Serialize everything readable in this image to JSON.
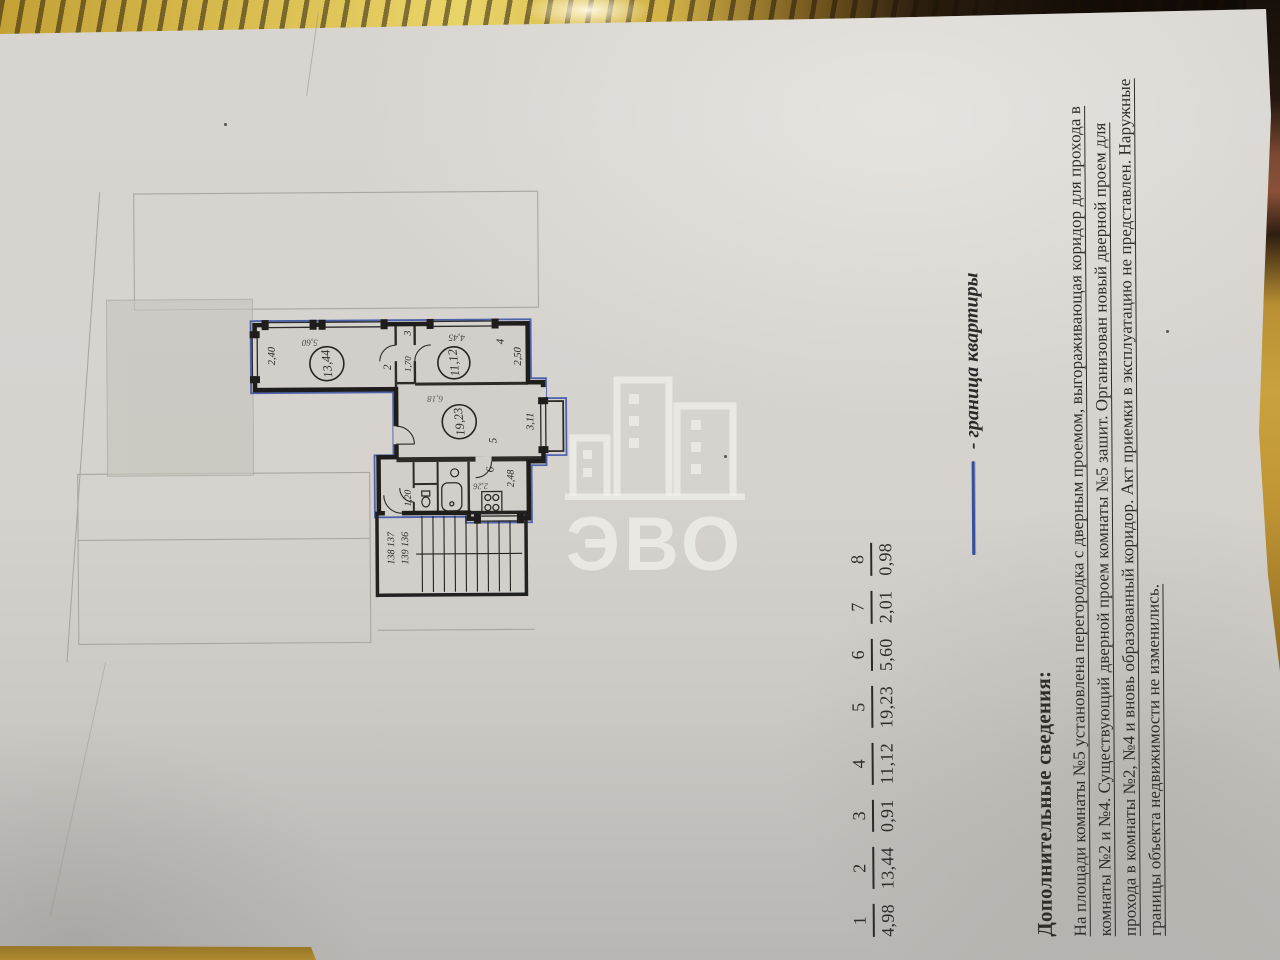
{
  "plan": {
    "room2": {
      "number": "2",
      "area": "13,44",
      "width_dim": "2,40",
      "length_dim": "5,60"
    },
    "room3": {
      "number": "3",
      "width_dim": "1,70"
    },
    "room4": {
      "number": "4",
      "area": "11,12",
      "width_dim": "2,50",
      "length_dim": "4,45"
    },
    "room5": {
      "number": "5",
      "area": "19,23",
      "width_dim": "3,11",
      "length_dim": "6,18"
    },
    "kitchen": {
      "number": "6",
      "width_dim": "2,48",
      "length_dim": "2,26"
    },
    "hall": {
      "width_dim": "1,20"
    },
    "stairwell": {
      "apartments_line1": "138 137",
      "apartments_line2": "139 136"
    }
  },
  "area_table": {
    "items": [
      {
        "n": "1",
        "v": "4,98"
      },
      {
        "n": "2",
        "v": "13,44"
      },
      {
        "n": "3",
        "v": "0,91"
      },
      {
        "n": "4",
        "v": "11,12"
      },
      {
        "n": "5",
        "v": "19,23"
      },
      {
        "n": "6",
        "v": "5,60"
      },
      {
        "n": "7",
        "v": "2,01"
      },
      {
        "n": "8",
        "v": "0,98"
      }
    ]
  },
  "legend": {
    "label": "- граница квартиры",
    "line_color": "#36509f"
  },
  "additional_info": {
    "title": "Дополнительные сведения:",
    "lines": [
      "На площади комнаты №5 установлена перегородка с дверным проемом, выгораживающая коридор для прохода в",
      "комнаты №2 и №4. Существующий дверной проем комнаты №5 зашит. Организован новый дверной проем для",
      "прохода в комнаты №2, №4 и вновь образованный коридор. Акт приемки в эксплуатацию не представлен. Наружные",
      "границы объекта недвижимости не изменились."
    ]
  },
  "watermark": {
    "text": "ЭВО"
  }
}
